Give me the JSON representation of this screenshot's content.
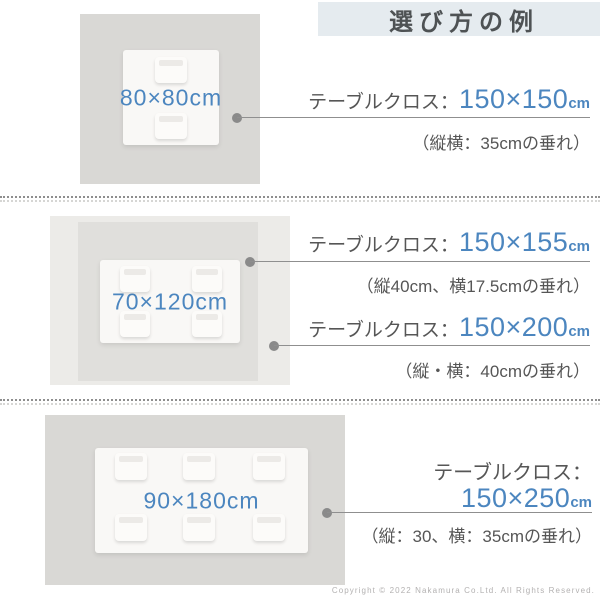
{
  "title": "選び方の例",
  "sections": [
    {
      "table_label": "80×80cm",
      "specs": [
        {
          "label": "テーブルクロス：",
          "size": "150×150",
          "unit": "cm",
          "note": "（縦横：35cmの垂れ）"
        }
      ]
    },
    {
      "table_label": "70×120cm",
      "specs": [
        {
          "label": "テーブルクロス：",
          "size": "150×155",
          "unit": "cm",
          "note": "（縦40cm、横17.5cmの垂れ）"
        },
        {
          "label": "テーブルクロス：",
          "size": "150×200",
          "unit": "cm",
          "note": "（縦・横：40cmの垂れ）"
        }
      ]
    },
    {
      "table_label": "90×180cm",
      "specs": [
        {
          "label": "テーブルクロス：",
          "size": "150×250",
          "unit": "cm",
          "note": "（縦：30、横：35cmの垂れ）"
        }
      ]
    }
  ],
  "footer": {
    "copyright": "Copyright © 2022 Nakamura Co.Ltd. All Rights Reserved."
  },
  "colors": {
    "accent_blue": "#4c86bf",
    "text_gray": "#565656",
    "title_bg": "#e5ebef",
    "cloth_gray": "#d9d8d5",
    "cloth_light_gray": "#ecebe8",
    "cloth_mid_gray": "#e0dfdc"
  }
}
